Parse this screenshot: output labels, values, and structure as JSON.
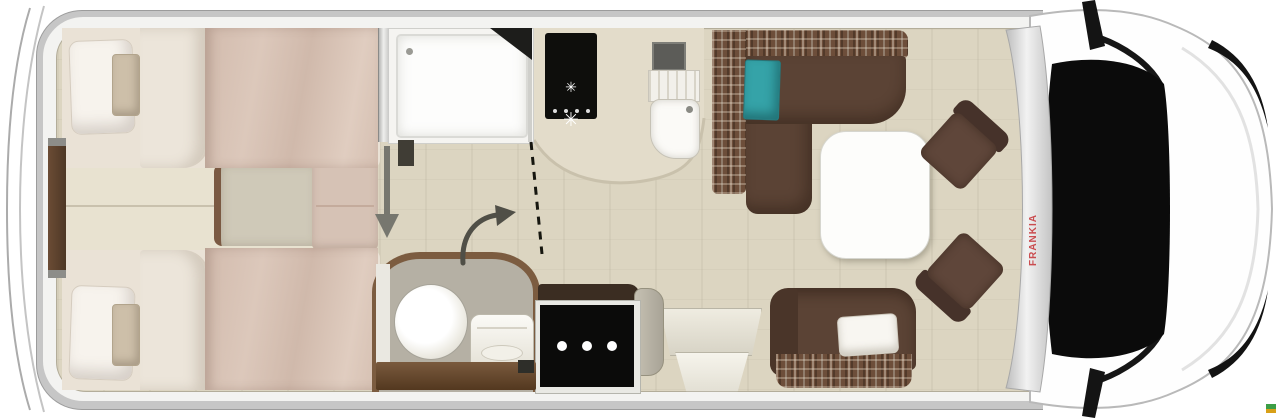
{
  "vehicle": {
    "brand_label": "FRANKIA"
  },
  "icons": {
    "burner_glyph": "✳",
    "burner_icon": "gas-burner",
    "arrow_down_icon": "walkway-arrow",
    "arrow_curved_icon": "door-swing-arrow"
  },
  "colors": {
    "body_shell": "#c6c6c6",
    "floor": "#dcd5c1",
    "bed_blanket": "#d9c3b6",
    "bed_linen": "#f7f3ed",
    "sofa_brown": "#5b4335",
    "plaid_base": "#6d4e3a",
    "teal_cushion": "#35a3a8",
    "appliance_black": "#0b0b0a",
    "cooktop_black": "#0e0e0c",
    "wood_trim": "#7a5a3e",
    "windshield_black": "#0b0b0b",
    "brand_red": "#c3272b",
    "watermark_green": "#3c9e46",
    "watermark_yellow": "#d8a018"
  }
}
